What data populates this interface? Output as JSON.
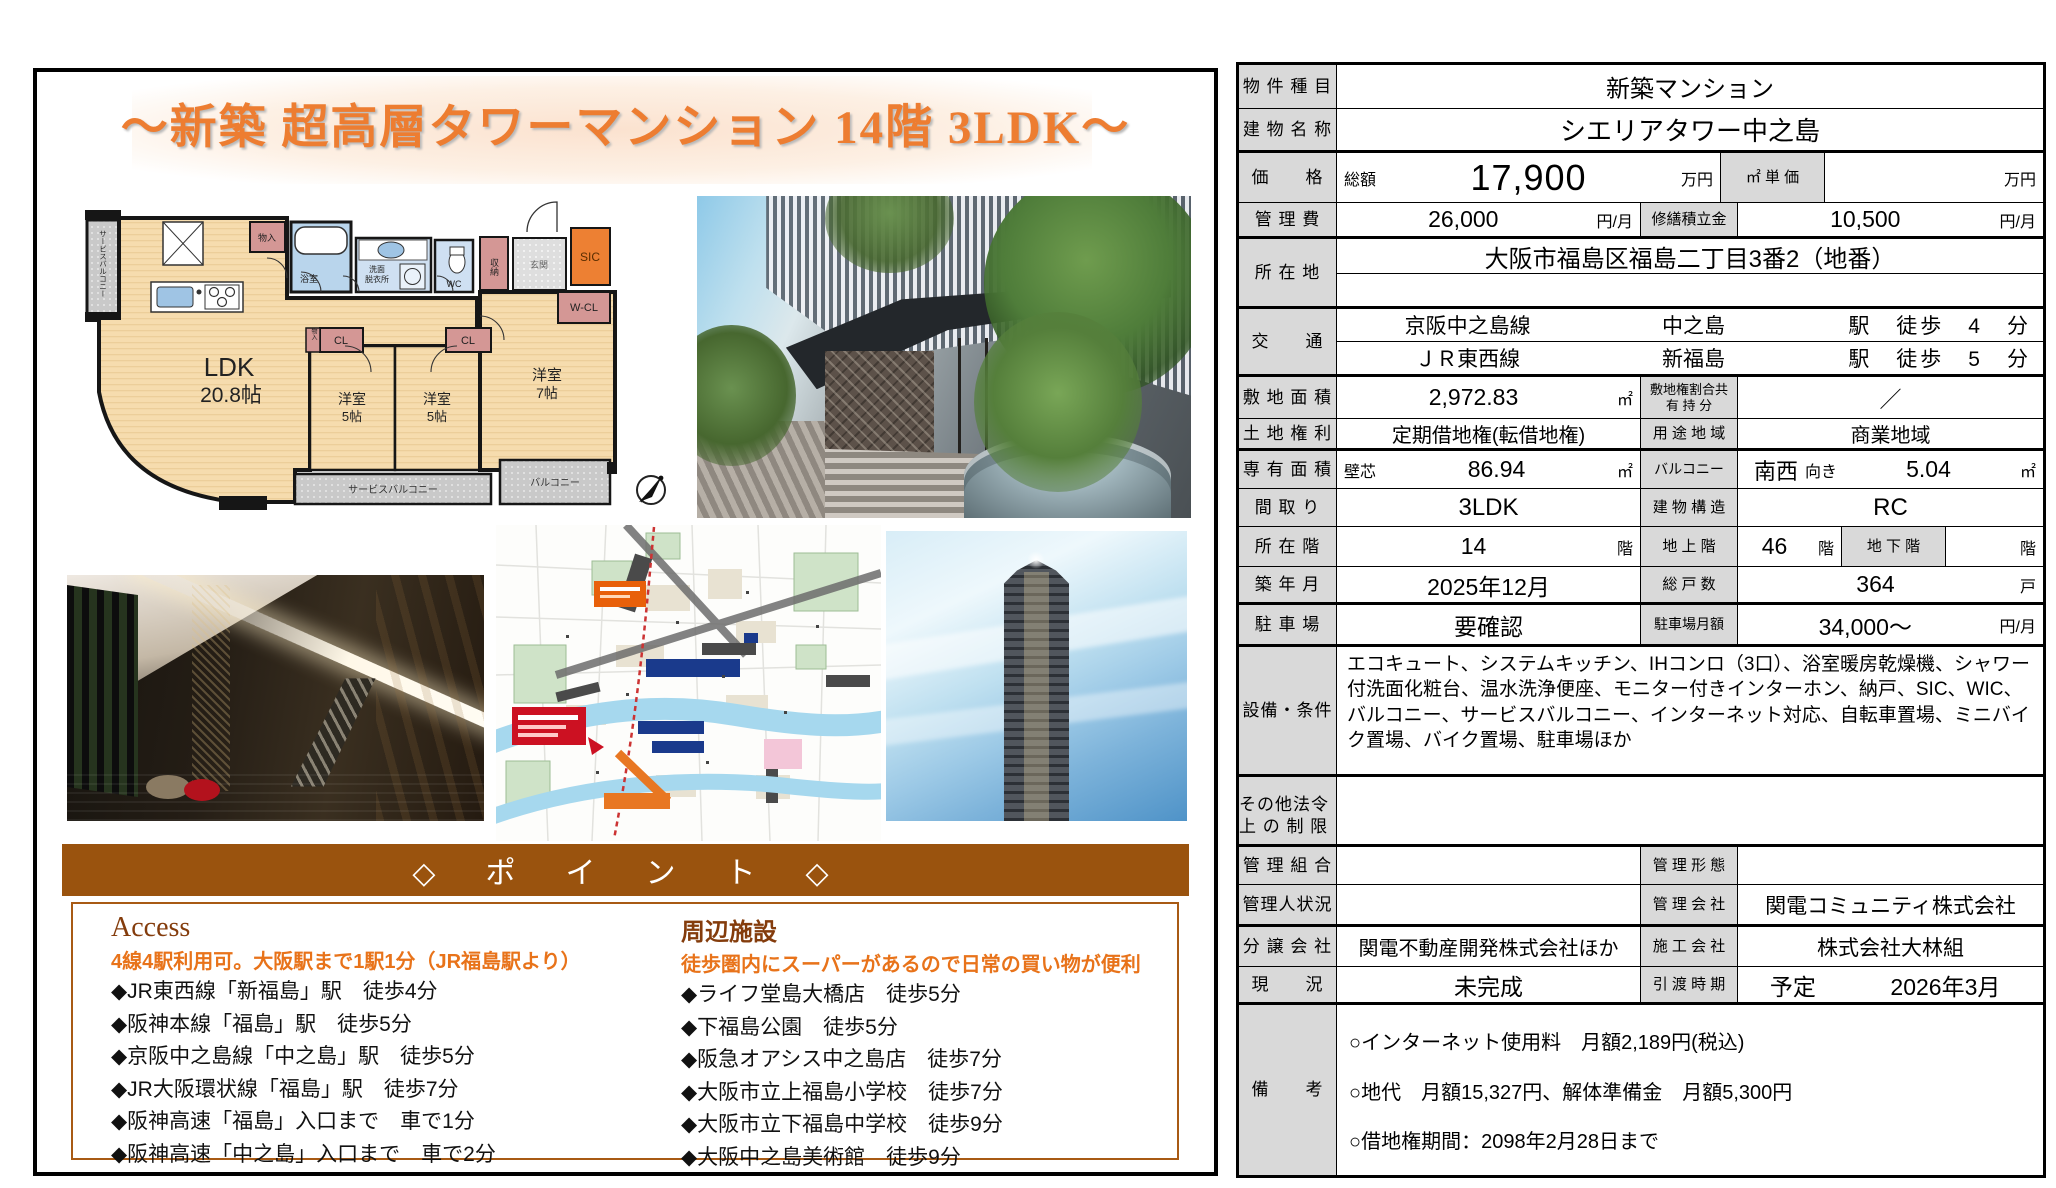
{
  "flyer": {
    "title": "〜新築 超高層タワーマンション 14階 3LDK〜",
    "points_banner": "◇　ポ　イ　ン　ト　◇",
    "access": {
      "heading": "Access",
      "subheading": "4線4駅利用可。大阪駅まで1駅1分（JR福島駅より）",
      "items": [
        "◆JR東西線「新福島」駅　徒歩4分",
        "◆阪神本線「福島」駅　徒歩5分",
        "◆京阪中之島線「中之島」駅　徒歩5分",
        "◆JR大阪環状線「福島」駅　徒歩7分",
        "◆阪神高速「福島」入口まで　車で1分",
        "◆阪神高速「中之島」入口まで　車で2分"
      ]
    },
    "facilities": {
      "heading": "周辺施設",
      "subheading": "徒歩圏内にスーパーがあるので日常の買い物が便利",
      "items": [
        "◆ライフ堂島大橋店　徒歩5分",
        "◆下福島公園　徒歩5分",
        "◆阪急オアシス中之島店　徒歩7分",
        "◆大阪市立上福島小学校　徒歩7分",
        "◆大阪市立下福島中学校　徒歩9分",
        "◆大阪中之島美術館　徒歩9分"
      ]
    }
  },
  "floorplan": {
    "ldk_label": "LDK",
    "ldk_size": "20.8帖",
    "bedroom1_label": "洋室",
    "bedroom1_size": "5帖",
    "bedroom2_label": "洋室",
    "bedroom2_size": "5帖",
    "bedroom3_label": "洋室",
    "bedroom3_size": "7帖",
    "closet1": "CL",
    "closet2": "CL",
    "walkin_closet": "W-CL",
    "shoes_closet": "SIC",
    "storage": "収納",
    "storage_top": "物入",
    "storage_mid": "物入",
    "bath": "浴室",
    "washroom_1": "洗面",
    "washroom_2": "脱衣所",
    "toilet": "WC",
    "entrance": "玄関",
    "service_balcony_side": "サービスバルコニー",
    "service_balcony_bottom": "サービスバルコニー",
    "balcony": "バルコニー"
  },
  "spec": {
    "property_type": {
      "label": "物 件 種 目",
      "value": "新築マンション"
    },
    "building_name": {
      "label": "建 物 名 称",
      "value": "シエリアタワー中之島"
    },
    "price": {
      "label": "価　　格",
      "prefix": "総額",
      "amount": "17,900",
      "unit": "万円",
      "unit_label": "㎡ 単 価",
      "unit_value": "",
      "unit_unit": "万円"
    },
    "management_fee": {
      "label": "管 理 費",
      "amount": "26,000",
      "unit": "円/月",
      "repair_label": "修繕積立金",
      "repair_amount": "10,500",
      "repair_unit": "円/月"
    },
    "location": {
      "label": "所 在 地",
      "value": "大阪市福島区福島二丁目3番2（地番）"
    },
    "transport": {
      "label": "交　　通",
      "lines": [
        {
          "line": "京阪中之島線",
          "station": "中之島",
          "walk": "駅　徒歩　4　分"
        },
        {
          "line": "ＪＲ東西線",
          "station": "新福島",
          "walk": "駅　徒歩　5　分"
        }
      ]
    },
    "site_area": {
      "label": "敷 地 面 積",
      "amount": "2,972.83",
      "unit": "㎡",
      "share_label_1": "敷地権割合共",
      "share_label_2": "有 持 分",
      "share_value": "／"
    },
    "land_rights": {
      "label": "土 地 権 利",
      "value": "定期借地権(転借地権)",
      "zone_label": "用 途 地 域",
      "zone_value": "商業地域"
    },
    "exclusive_area": {
      "label": "専 有 面 積",
      "prefix": "壁芯",
      "amount": "86.94",
      "unit": "㎡",
      "balcony_label": "バルコニー",
      "balcony_dir": "南西",
      "balcony_muki": "向き",
      "balcony_amount": "5.04",
      "balcony_unit": "㎡"
    },
    "layout": {
      "label": "間 取 り",
      "value": "3LDK",
      "structure_label": "建 物 構 造",
      "structure_value": "RC"
    },
    "floor": {
      "label": "所 在 階",
      "value": "14",
      "unit": "階",
      "above_label": "地 上 階",
      "above_value": "46",
      "above_unit": "階",
      "below_label": "地 下 階",
      "below_value": "",
      "below_unit": "階"
    },
    "built": {
      "label": "築 年 月",
      "value": "2025年12月",
      "units_label": "総 戸 数",
      "units_value": "364",
      "units_unit": "戸"
    },
    "parking": {
      "label": "駐 車 場",
      "value": "要確認",
      "monthly_label": "駐車場月額",
      "monthly_value": "34,000〜",
      "monthly_unit": "円/月"
    },
    "equipment": {
      "label": "設備・条件",
      "value": "エコキュート、システムキッチン、IHコンロ（3口）、浴室暖房乾燥機、シャワー付洗面化粧台、温水洗浄便座、モニター付きインターホン、納戸、SIC、WIC、バルコニー、サービスバルコニー、インターネット対応、自転車置場、ミニバイク置場、バイク置場、駐車場ほか"
    },
    "legal": {
      "label_1": "その他法令",
      "label_2": "上 の 制 限",
      "value": ""
    },
    "mgmt_assoc": {
      "label": "管 理 組 合",
      "value": "",
      "form_label": "管 理 形 態",
      "form_value": ""
    },
    "manager": {
      "label": "管理人状況",
      "value": "",
      "company_label": "管 理 会 社",
      "company_value": "関電コミュニティ株式会社"
    },
    "seller": {
      "label": "分 譲 会 社",
      "value": "関電不動産開発株式会社ほか",
      "builder_label": "施 工 会 社",
      "builder_value": "株式会社大林組"
    },
    "status": {
      "label": "現　　況",
      "value": "未完成",
      "delivery_label": "引 渡 時 期",
      "delivery_prefix": "予定",
      "delivery_value": "2026年3月"
    },
    "remarks": {
      "label": "備　　考",
      "lines": [
        "○インターネット使用料　月額2,189円(税込)",
        "○地代　月額15,327円、解体準備金　月額5,300円",
        "○借地権期間：2098年2月28日まで"
      ]
    }
  },
  "colors": {
    "accent_orange": "#ed7d31",
    "banner_brown": "#9a530e",
    "label_gray": "#d9d9d9",
    "highlight_orange": "#e8731a"
  }
}
